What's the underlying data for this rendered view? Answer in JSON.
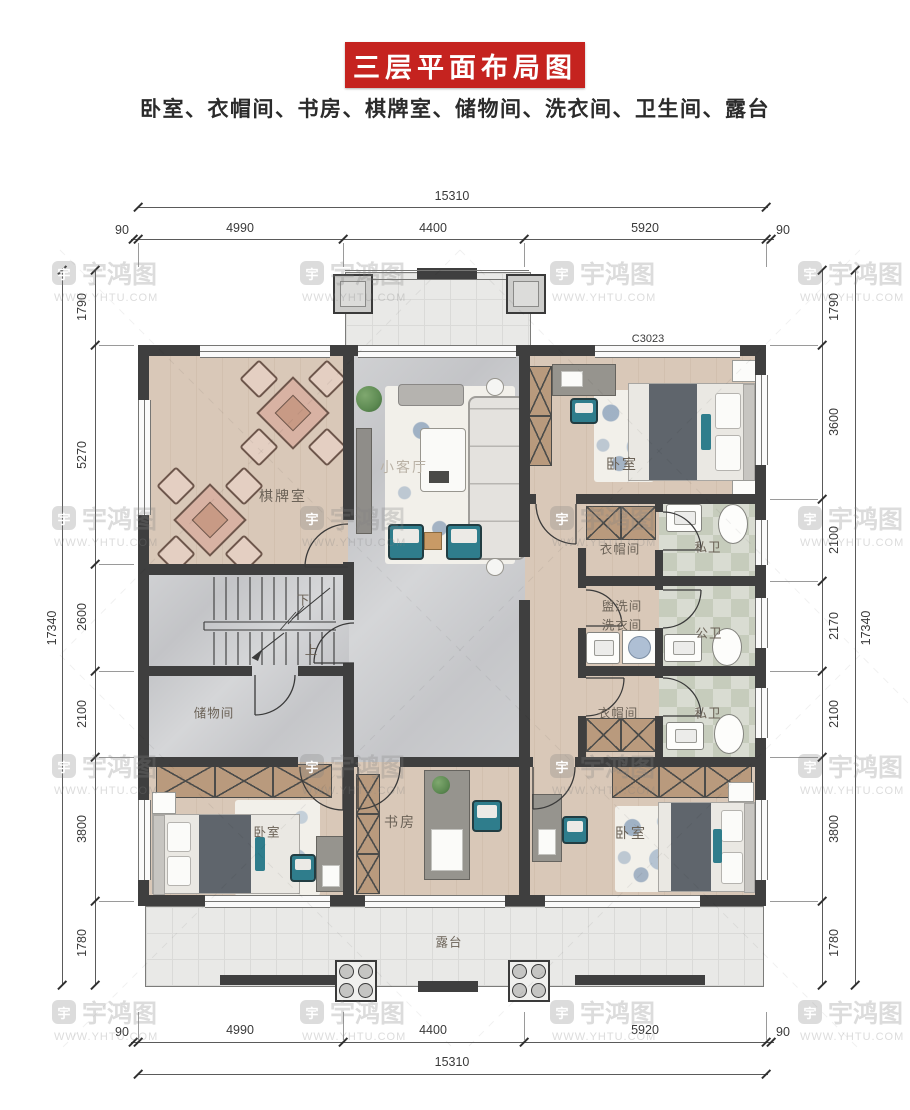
{
  "title": {
    "banner": "三层平面布局图",
    "subtitle": "卧室、衣帽间、书房、棋牌室、储物间、洗衣间、卫生间、露台"
  },
  "watermark": {
    "brand": "宇鸿图",
    "url": "WWW.YHTU.COM",
    "logo_glyph": "宇"
  },
  "window_code": "C3023",
  "stairs": {
    "down": "下",
    "up": "上"
  },
  "rooms": {
    "chess": "棋牌室",
    "living": "小客厅",
    "bedroom_top": "卧室",
    "cloak_top": "衣帽间",
    "private_bath_top": "私卫",
    "washroom_line1": "盥洗间",
    "washroom_line2": "洗衣间",
    "public_bath": "公卫",
    "cloak_bottom": "衣帽间",
    "private_bath_bottom": "私卫",
    "storage": "储物间",
    "bedroom_left": "卧室",
    "study": "书房",
    "bedroom_right": "卧室",
    "terrace": "露台"
  },
  "dimensions": {
    "top": {
      "total": "15310",
      "segments": [
        "90",
        "4990",
        "4400",
        "5920",
        "90"
      ]
    },
    "bottom": {
      "total": "15310",
      "segments": [
        "90",
        "4990",
        "4400",
        "5920",
        "90"
      ]
    },
    "left": {
      "total": "17340",
      "segments": [
        "1790",
        "5270",
        "2600",
        "2100",
        "3800",
        "1780"
      ]
    },
    "right": {
      "total": "17340",
      "segments": [
        "1790",
        "3600",
        "2100",
        "2170",
        "2100",
        "3800",
        "1780"
      ]
    }
  },
  "colors": {
    "banner_red": "#c5231f",
    "wall": "#3f3f3f",
    "wood_floor": "#d9c8b8",
    "marble_floor": "#cbccce",
    "bath_tile": "#c6ccbc",
    "accent_teal": "#2f7d8c"
  }
}
